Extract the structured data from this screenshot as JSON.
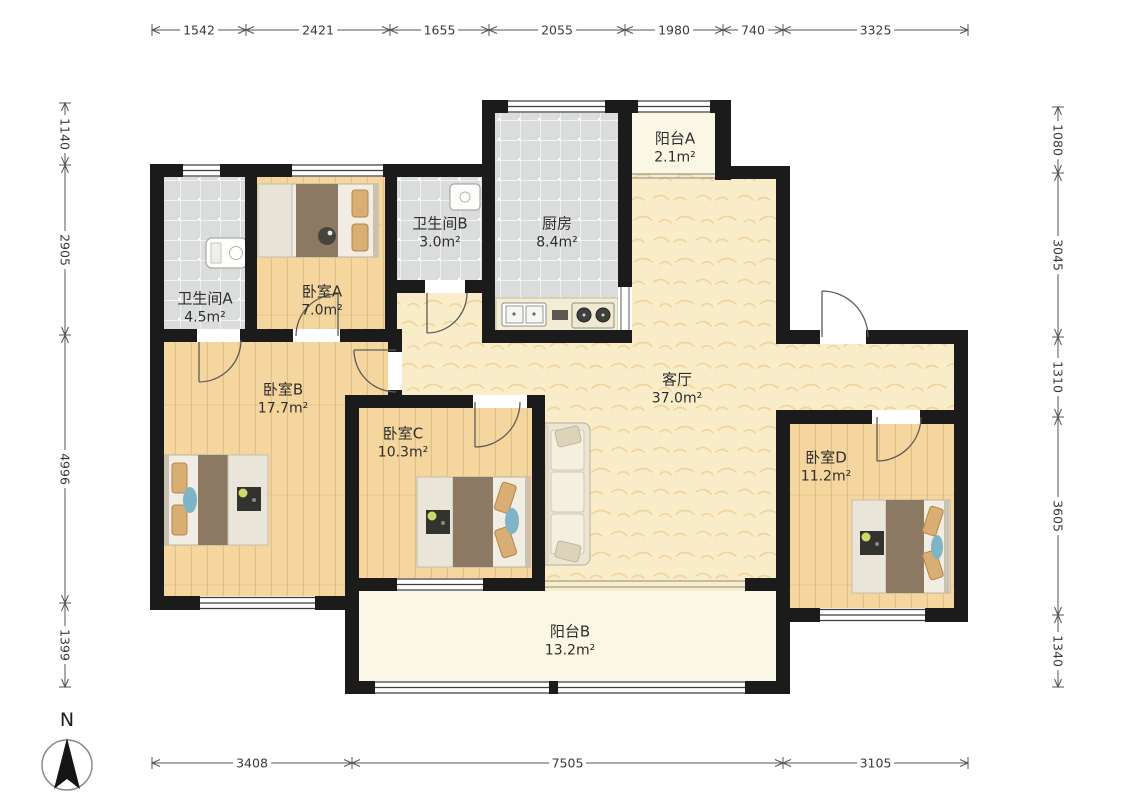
{
  "north": {
    "label": "N"
  },
  "rooms": [
    {
      "id": "bathroom-a",
      "name": "卫生间A",
      "area": "4.5m²"
    },
    {
      "id": "bedroom-a",
      "name": "卧室A",
      "area": "7.0m²"
    },
    {
      "id": "bathroom-b",
      "name": "卫生间B",
      "area": "3.0m²"
    },
    {
      "id": "kitchen",
      "name": "厨房",
      "area": "8.4m²"
    },
    {
      "id": "balcony-a",
      "name": "阳台A",
      "area": "2.1m²"
    },
    {
      "id": "living-room",
      "name": "客厅",
      "area": "37.0m²"
    },
    {
      "id": "bedroom-b",
      "name": "卧室B",
      "area": "17.7m²"
    },
    {
      "id": "bedroom-c",
      "name": "卧室C",
      "area": "10.3m²"
    },
    {
      "id": "bedroom-d",
      "name": "卧室D",
      "area": "11.2m²"
    },
    {
      "id": "balcony-b",
      "name": "阳台B",
      "area": "13.2m²"
    }
  ],
  "dimensions_mm": {
    "top": [
      "1542",
      "2421",
      "1655",
      "2055",
      "1980",
      "740",
      "3325"
    ],
    "left": [
      "1140",
      "2905",
      "4996",
      "1399"
    ],
    "right": [
      "1080",
      "3045",
      "1310",
      "3605",
      "1340"
    ],
    "bottom": [
      "3408",
      "7505",
      "3105"
    ]
  },
  "colors": {
    "wall": "#1b1b1b",
    "wood_floor": "#f4d69e",
    "living_floor": "#f9ecc9",
    "tile_floor": "#dadddb",
    "balcony_floor": "#fbf7e5",
    "blanket": "#8b7963",
    "pillow": "#d8ae74",
    "accent_blue": "#7fb3c8",
    "dim_text": "#3a3a3a"
  }
}
